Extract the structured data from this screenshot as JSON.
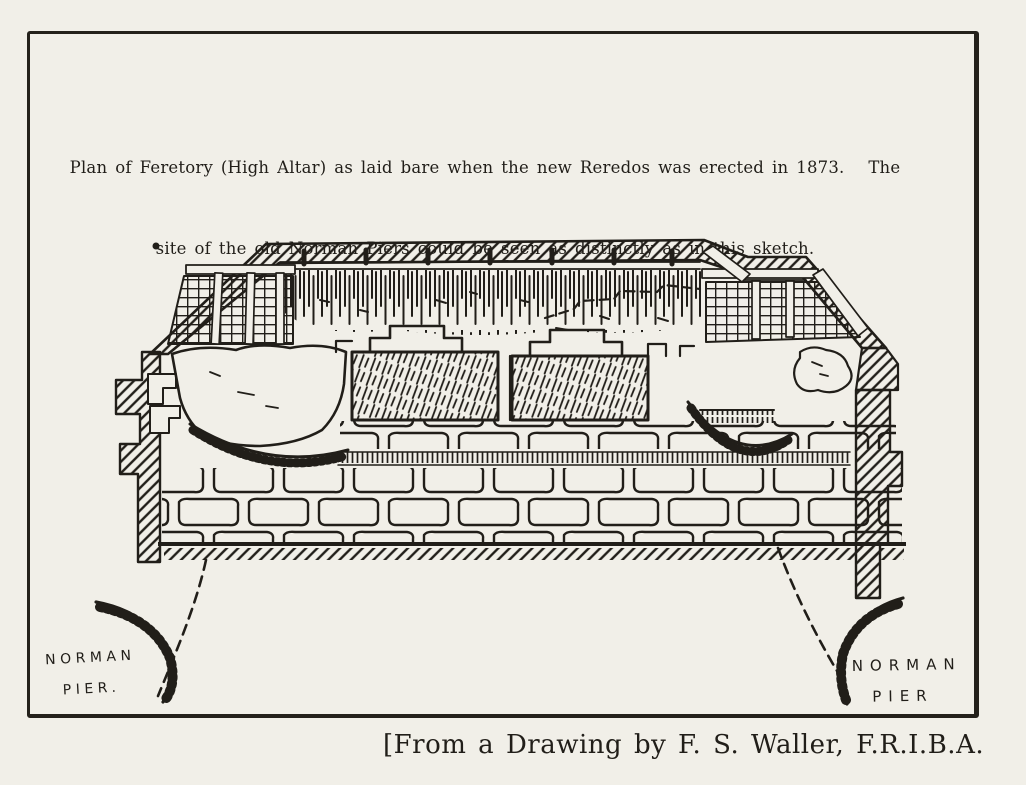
{
  "page": {
    "paper_color": "#f1efe8",
    "ink_color": "#211e19"
  },
  "figure": {
    "caption_line1": "Plan of Feretory (High Altar) as laid bare when the new Reredos was erected in 1873.   The",
    "caption_line2": "site of the old Norman Piers could be seen as distinctly as in this sketch.",
    "labels": {
      "left_pier_line1": "NORMAN",
      "left_pier_line2": "PIER.",
      "right_pier_line1": "NORMAN",
      "right_pier_line2": "PIER"
    },
    "credit": "[From a Drawing by F. S. Waller, F.R.I.B.A."
  }
}
